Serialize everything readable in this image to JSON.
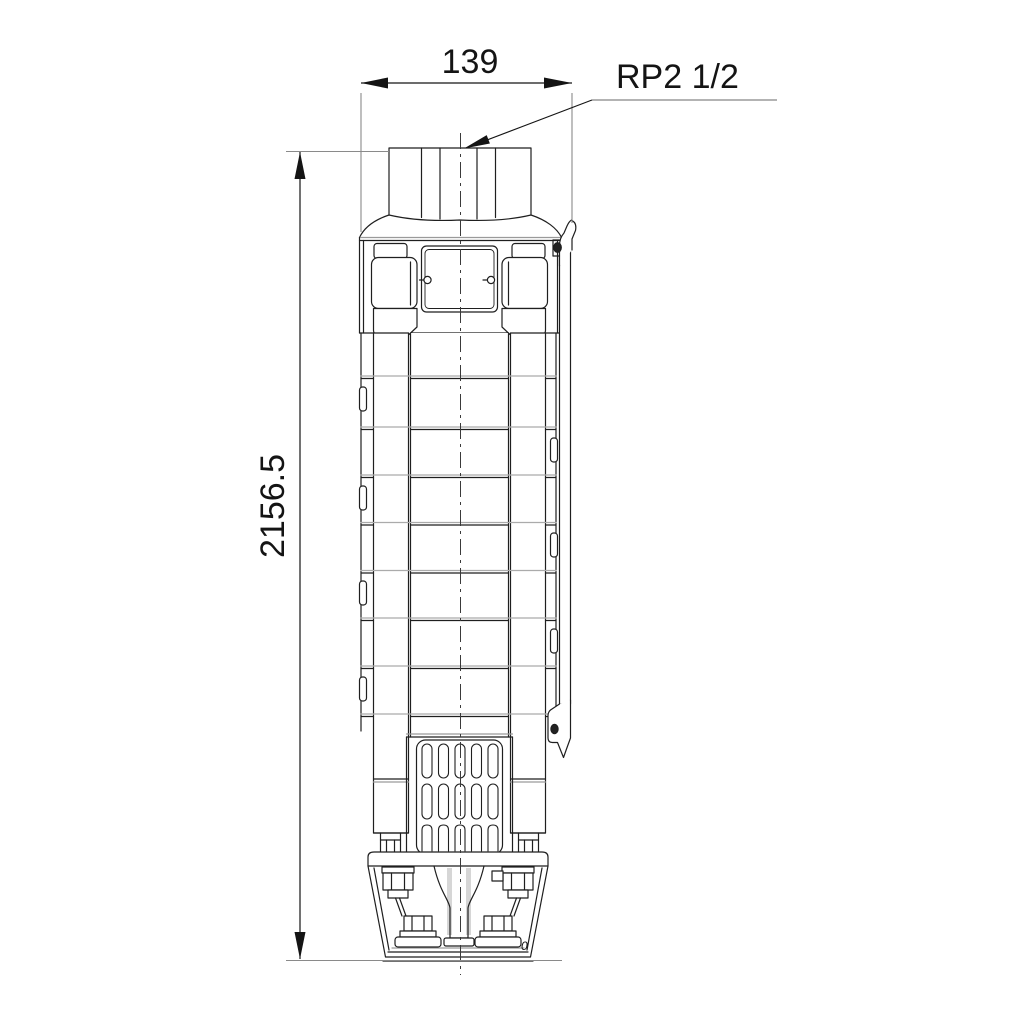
{
  "drawing": {
    "type": "technical dimensional drawing of a submersible borehole pump",
    "width_dimension": "139",
    "height_dimension": "2156.5",
    "connection_label": "RP2 1/2",
    "detail_mark": "0",
    "line_color": "#1a1a1a",
    "extension_line_color": "#8a8a8a",
    "background_color": "#ffffff"
  }
}
